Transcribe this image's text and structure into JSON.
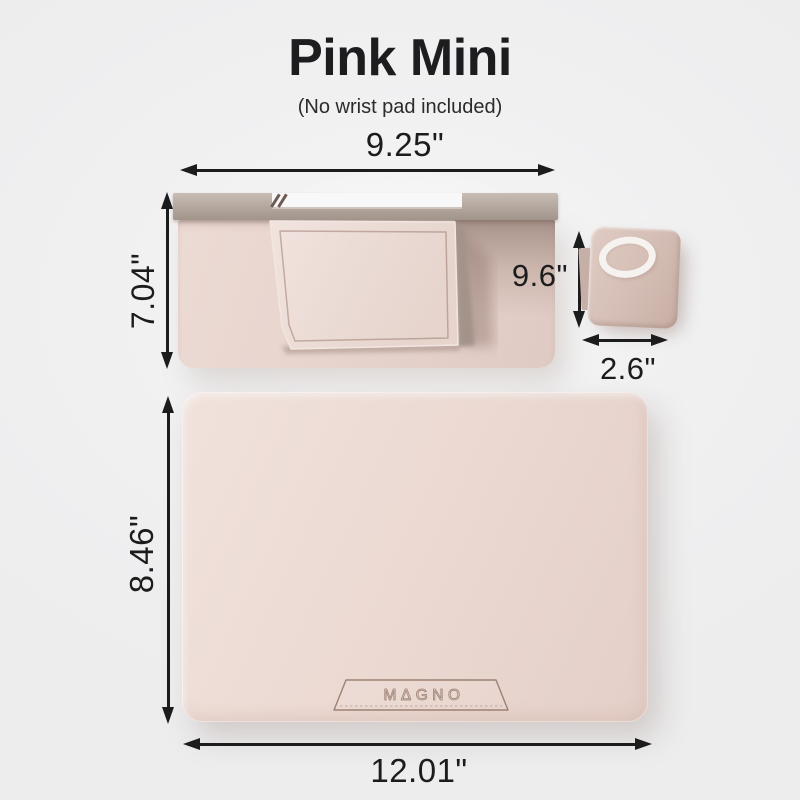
{
  "title": "Pink Mini",
  "subtitle": "(No wrist pad included)",
  "stand": {
    "width_label": "9.25\"",
    "height_label": "7.04\"",
    "depth_label": "9.6\""
  },
  "magsafe_stand": {
    "width_label": "2.6\""
  },
  "desk_mat": {
    "height_label": "8.46\"",
    "width_label": "12.01\"",
    "brand_logo": "MΔGNO"
  },
  "colors": {
    "ink": "#1c1c1c",
    "bar_mid": "#b2a69d",
    "base_light": "#ecdad4",
    "base_dark": "#dfcac3",
    "ms_light": "#dfccc4",
    "ms_dark": "#c7aea5",
    "ring": "#f6f2f0",
    "mat_light": "#f1e2dc",
    "mat_dark": "#e4cfc8",
    "brand_line": "#9c8173"
  }
}
